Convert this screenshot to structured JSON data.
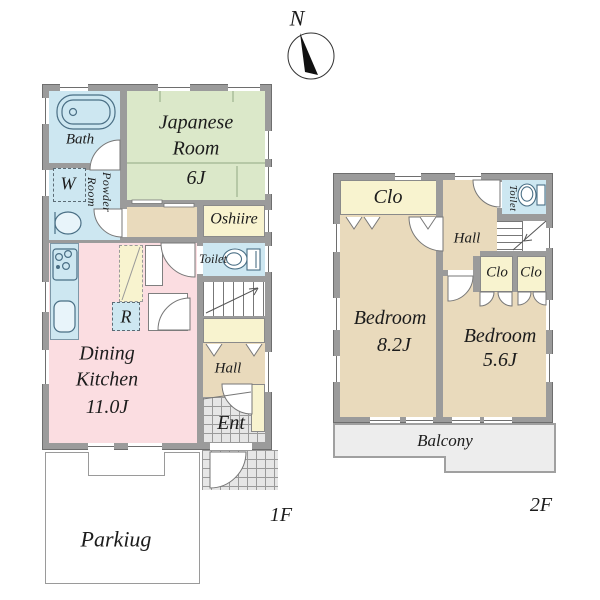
{
  "compass": {
    "north": "N"
  },
  "floor1": {
    "floor_label": "1F",
    "rooms": {
      "bath": "Bath",
      "washer": "W",
      "powder_room": "Powder Room",
      "japanese_room": "Japanese Room",
      "japanese_room_size": "6J",
      "oshiire": "Oshiire",
      "toilet": "Toilet",
      "refrigerator": "R",
      "dining_kitchen": "Dining Kitchen",
      "dining_kitchen_size": "11.0J",
      "hall": "Hall",
      "entrance": "Ent",
      "parking": "Parkiug"
    }
  },
  "floor2": {
    "floor_label": "2F",
    "rooms": {
      "closet_main": "Clo",
      "toilet": "Toilet",
      "hall": "Hall",
      "bedroom_large": "Bedroom",
      "bedroom_large_size": "8.2J",
      "closet_left": "Clo",
      "closet_right": "Clo",
      "bedroom_small": "Bedroom",
      "bedroom_small_size": "5.6J",
      "balcony": "Balcony"
    }
  },
  "colors": {
    "wall": "#9b9b9b",
    "water_rooms": "#cde7f1",
    "japanese_room": "#dbe8c9",
    "closets": "#f8f3cf",
    "dining_kitchen": "#fbdde1",
    "hall_bedrooms": "#e9dabc",
    "balcony": "#ededed"
  }
}
